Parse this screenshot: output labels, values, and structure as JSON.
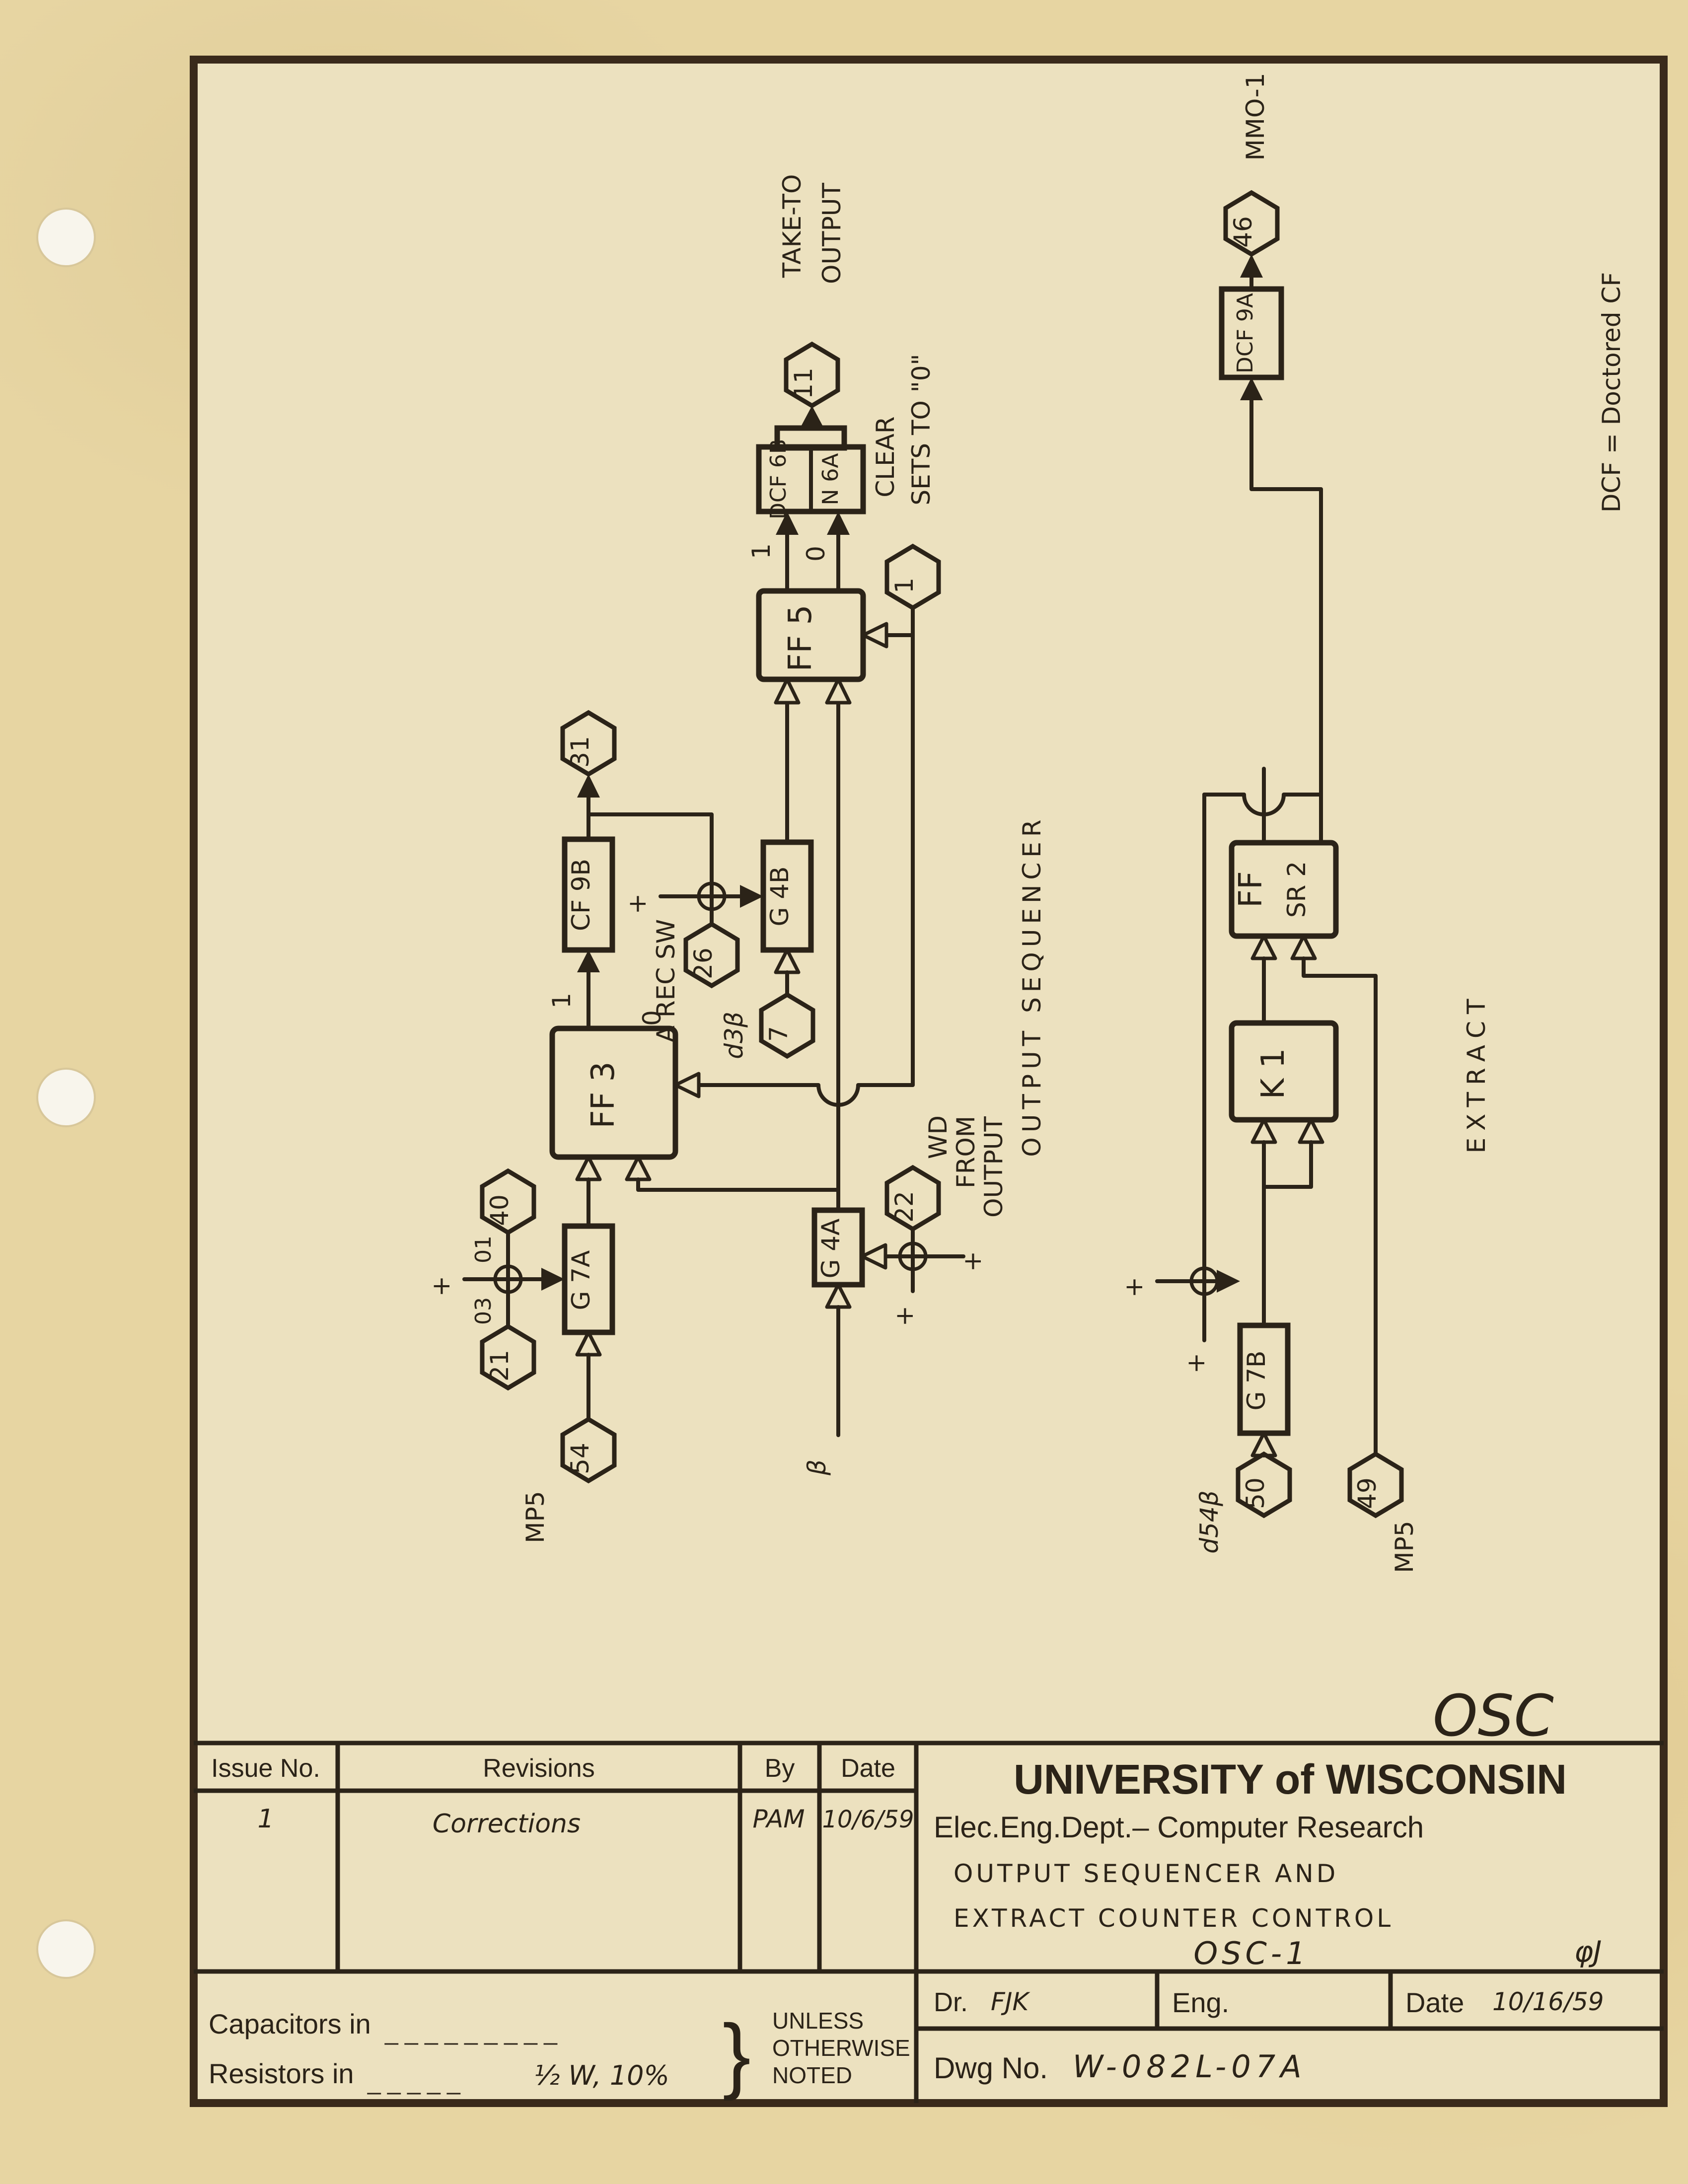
{
  "colors": {
    "paper": "#e7d5a2",
    "drawing_area": "#ece1bf",
    "ink": "#2b2318",
    "frame_line": "#3a2a1b",
    "punch_hole": "#f8f5ec"
  },
  "diagram": {
    "blocks": {
      "dcf6b": "DCF 6B",
      "n6a": "N 6A",
      "ff5": "FF 5",
      "cf9b": "CF 9B",
      "g4b": "G 4B",
      "ff3": "FF 3",
      "g7a": "G 7A",
      "g4a": "G 4A",
      "dcf9a": "DCF 9A",
      "ffsr2_l1": "FF",
      "ffsr2_l2": "SR 2",
      "k1": "K 1",
      "g7b": "G 7B"
    },
    "hexagons": {
      "h11": "11",
      "h1": "1",
      "h31": "31",
      "h26": "26",
      "h7": "7",
      "h40": "40",
      "h21": "21",
      "h54": "54",
      "h22": "22",
      "h46": "46",
      "h50": "50",
      "h49": "49"
    },
    "labels": {
      "take_to": "TAKE-TO",
      "take_out": "OUTPUT",
      "clear": "CLEAR",
      "sets": "SETS TO \"0\"",
      "one": "1",
      "zero": "0",
      "a_rec_sw": "A REC SW",
      "d3b": "d3β",
      "beta": "β",
      "mp5": "MP5",
      "o1": "01",
      "o3": "03",
      "wd": "WD",
      "from": "FROM",
      "output": "OUTPUT",
      "plus": "+",
      "out_seq": "OUTPUT  SEQUENCER",
      "extract": "EXTRACT",
      "mmo1": "MMO-1",
      "d54b": "d54β",
      "dcf_note": "DCF = Doctored CF",
      "osc": "OSC"
    }
  },
  "title_block": {
    "issue_no": "Issue No.",
    "revisions": "Revisions",
    "by": "By",
    "date": "Date",
    "row1": {
      "issue": "1",
      "revision": "Corrections",
      "by": "PAM",
      "date": "10/6/59"
    },
    "university": "UNIVERSITY of WISCONSIN",
    "dept": "Elec.Eng.Dept.– Computer Research",
    "drawing_title_1": "OUTPUT SEQUENCER AND",
    "drawing_title_2": "EXTRACT COUNTER CONTROL",
    "drawing_code": "OSC-1",
    "phi": "φJ",
    "dr_label": "Dr.",
    "dr_value": "FJK",
    "eng_label": "Eng.",
    "date_label": "Date",
    "date_value": "10/16/59",
    "dwg_label": "Dwg No.",
    "dwg_value": "W-082L-07A",
    "capacitors": "Capacitors in",
    "cap_dashes": "_  _  _  _  _  _  _  _  _",
    "resistors": "Resistors  in",
    "res_dashes": "_  _  _  _  _",
    "res_value": "½ W, 10%",
    "brace": "}",
    "unless_1": "UNLESS",
    "unless_2": "OTHERWISE",
    "unless_3": "NOTED"
  }
}
